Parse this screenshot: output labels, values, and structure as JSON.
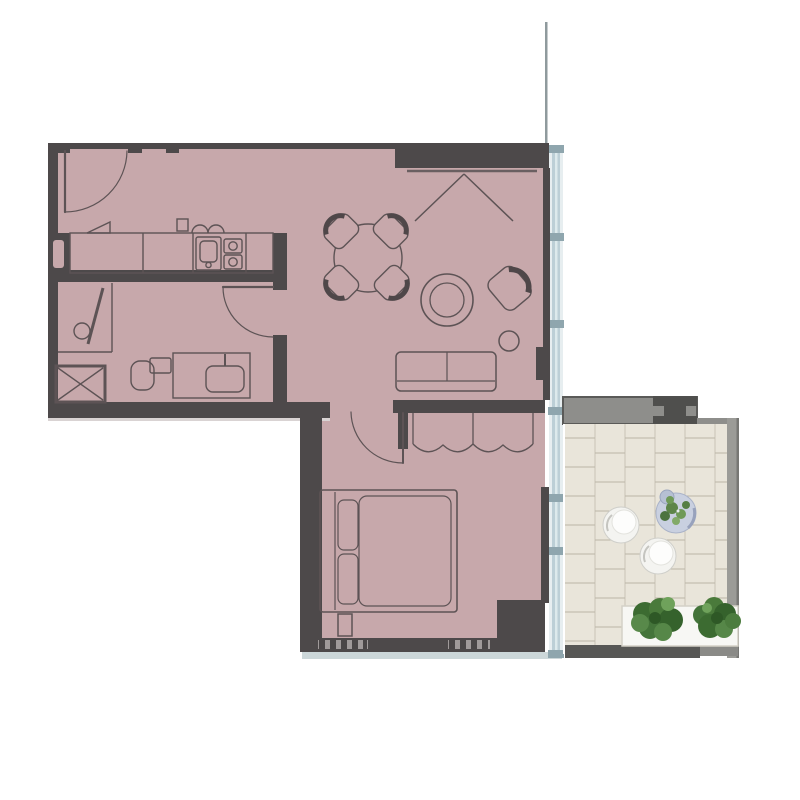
{
  "meta": {
    "title": "apartment-floor-plan",
    "description": "one-bedroom apartment floor plan with balcony terrace, no text labels visible"
  },
  "colors": {
    "background": "#ffffff",
    "floor": "#c7a8ab",
    "wall": "#4d494a",
    "line": "#5d5355",
    "line_bold": "#4f4749",
    "boundary_line": "#8f9a9d",
    "glass": "#bccfd6",
    "glass_light": "#e7eef0",
    "glass_frame": "#8fa6ae",
    "balcony_wall": "#8e8e8b",
    "balcony_wall_dark": "#4f4f4d",
    "deck": "#e9e5da",
    "deck_line": "#c9c4b6",
    "deck_joint": "#bab5a7",
    "deck_edge": "#9b9b97",
    "deck_edge_line": "#777774",
    "exterior_band": "#ccd7d9",
    "shadow": "#d9d3d3",
    "hatch_base": "#a09a9a",
    "band_dark": "#575755",
    "band_gray": "#8a8a87",
    "planter": "#f7f7f4",
    "planter_edge": "#d4d1c7",
    "foliage_dark": "#35622c",
    "foliage_mid": "#4c7c3e",
    "foliage_light": "#6fa25b",
    "chair_white": "#f4f4f1",
    "chair_edge": "#cfcfca",
    "chair_inner": "#fdfdfc",
    "side_table": "#c9d0e0",
    "side_table_edge": "#aab3c8",
    "sphere": "#b6c0d3"
  },
  "regions": {
    "entry_hall": "entry-hall",
    "kitchen": "kitchen",
    "bathroom": "bathroom",
    "living_dining": "living-dining-room",
    "bedroom": "bedroom",
    "balcony": "balcony-terrace"
  },
  "furniture": {
    "entry_door": "entry-door-with-swing",
    "kitchen_counter": "kitchen-counter-with-sink-and-cooktop",
    "shaft": "service-shaft",
    "shower": "shower",
    "washing_machine": "washing-machine",
    "toilet": "toilet",
    "vanity": "vanity-sink",
    "bathroom_door": "bathroom-door-with-swing",
    "dining_table": "round-dining-table-4-chairs",
    "round_table": "round-coffee-table",
    "armchair": "armchair",
    "pouf": "pouf",
    "sofa": "two-seat-sofa",
    "wardrobe_top": "built-in-closet",
    "bedroom_wardrobe": "built-in-wardrobe",
    "bedroom_door": "bedroom-door-with-swing",
    "bed": "double-bed",
    "nightstand": "nightstand",
    "lounge_chairs": "balcony-round-lounge-chairs",
    "balcony_table": "balcony-side-table-with-plant",
    "planter": "planter-box-with-hedges"
  },
  "deck_pattern": {
    "columns": [
      565,
      595,
      625,
      655,
      685,
      715,
      729
    ],
    "joint_start_y": 438,
    "joint_step": 29,
    "joint_stagger": 15,
    "joint_end_y": 644
  }
}
